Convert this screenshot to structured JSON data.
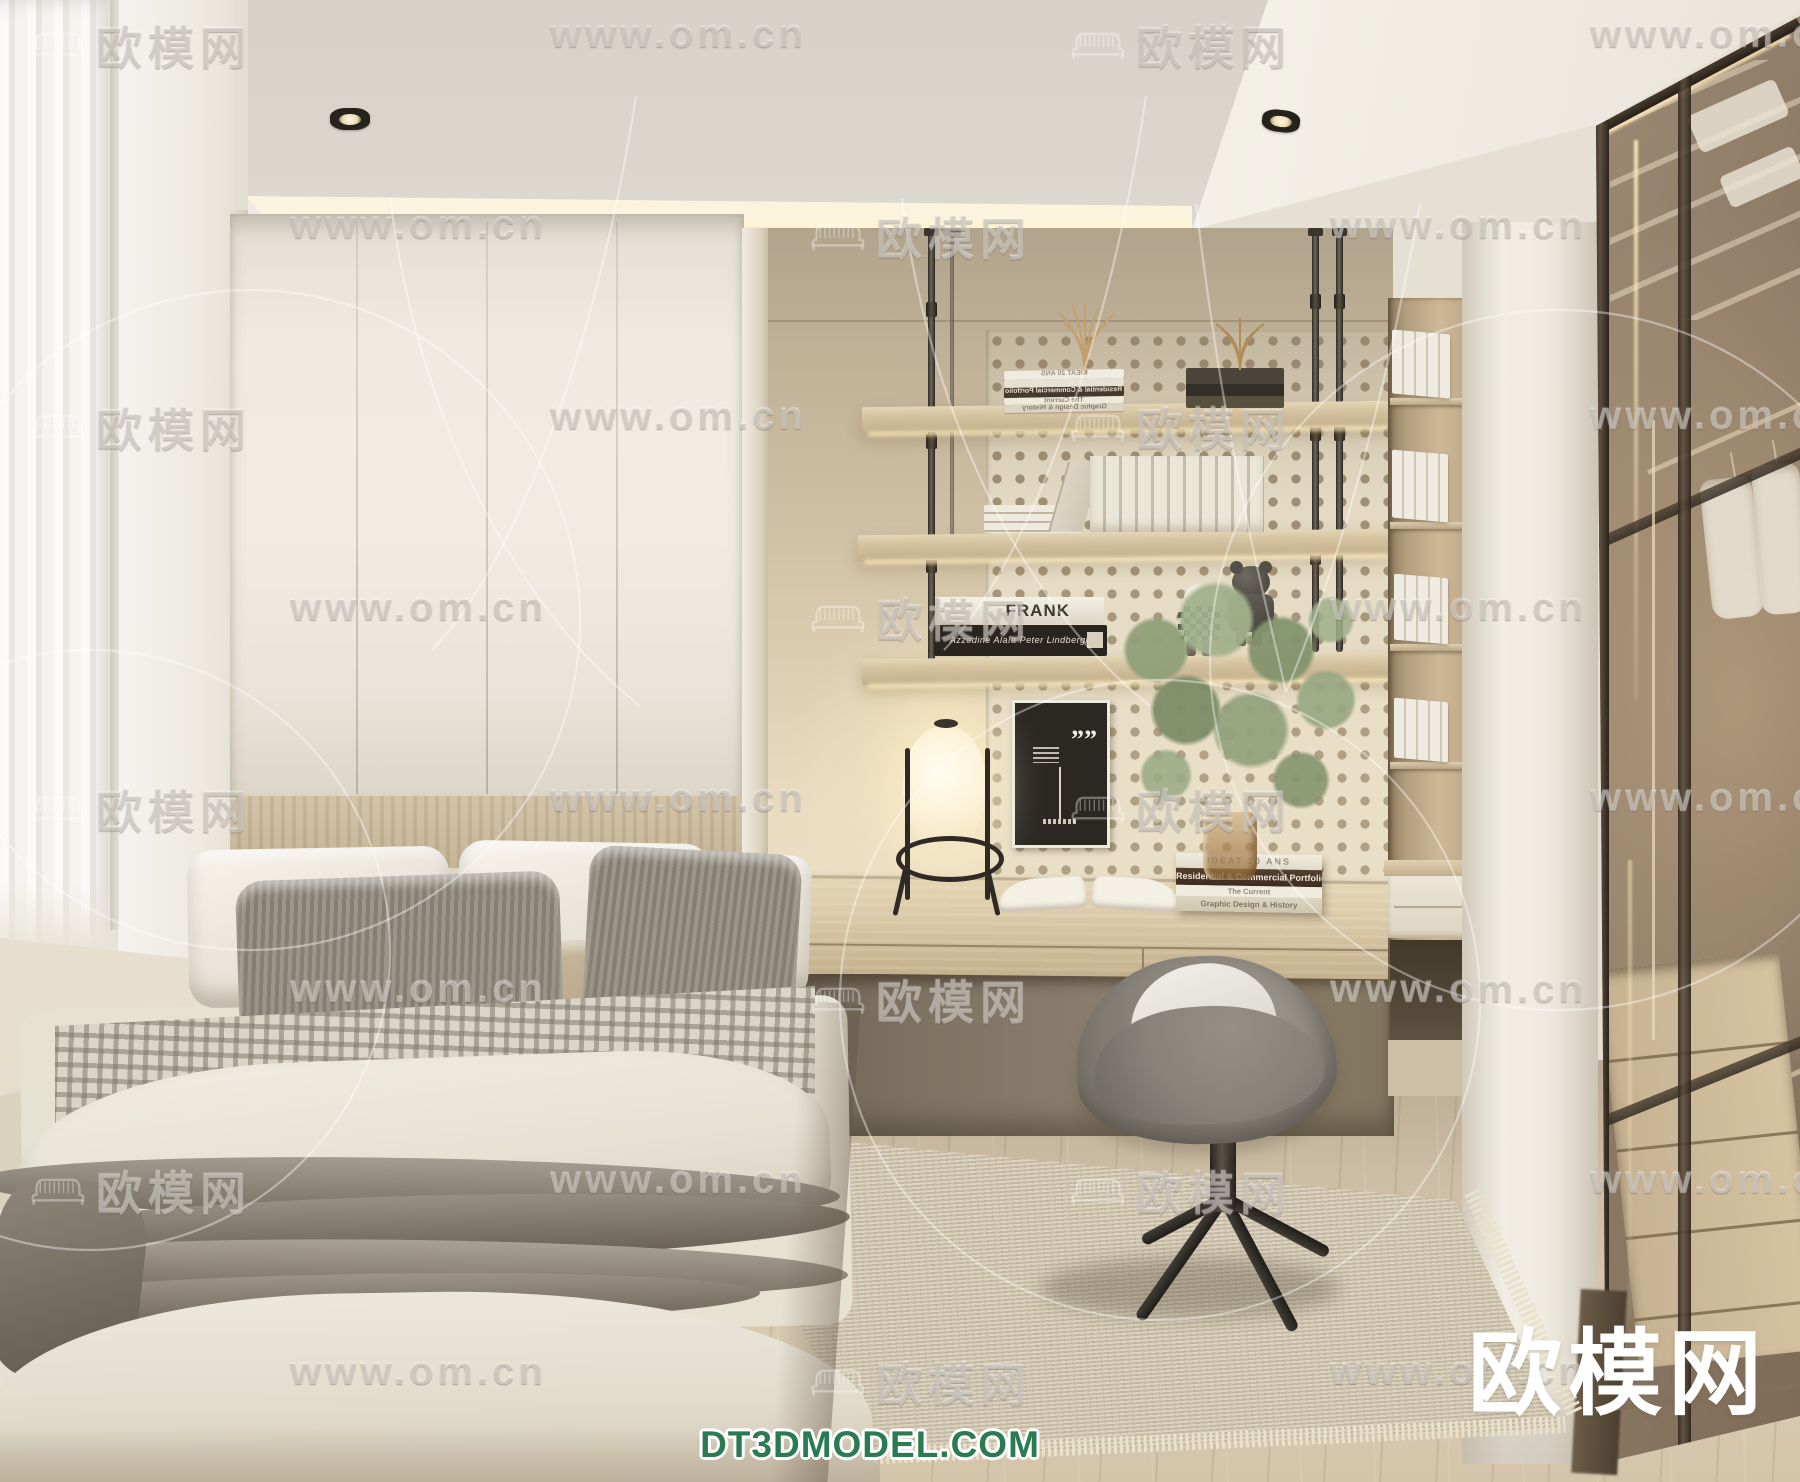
{
  "image": {
    "type": "3d-interior-render",
    "room": "bedroom-with-study-nook-and-glass-wardrobe",
    "style": "cream-minimal-japandi"
  },
  "watermarks": {
    "url_text": "www.om.cn",
    "brand_text": "欧模网",
    "brand_logo": "欧模网",
    "footer_site": "DT3DMODEL.COM",
    "footer_color": "#2a7a52",
    "tile_color": "rgba(255,255,255,0.34)"
  },
  "shelf_books": {
    "frank_spine": "FRANK",
    "black_spine": "Azzedine Alaïa Peter Lindbergh"
  },
  "desk_books": [
    "IDEAT 20 ANS",
    "Residential & Commercial Portfolio",
    "The Current",
    "Graphic Design & History"
  ],
  "poster": {
    "quote_mark": "”"
  },
  "palette": {
    "ceiling": "#d8d4cc",
    "cove_light": "#fbf3de",
    "wardrobe_white": "#efebe2",
    "niche_wall": "#d7c8ac",
    "pegboard": "#e4dac4",
    "wood_shelf": "#d5c3a1",
    "desk_wood": "#dbcaa9",
    "under_desk_shadow": "#7d7160",
    "chair_gray": "#8b867e",
    "rug_beige": "#d4c9b3",
    "floor_wood": "#ccbda4",
    "glass_bronze": "#8a7863",
    "blanket_gray": "#8a8378",
    "lamp_glow": "#fdf2d7"
  }
}
